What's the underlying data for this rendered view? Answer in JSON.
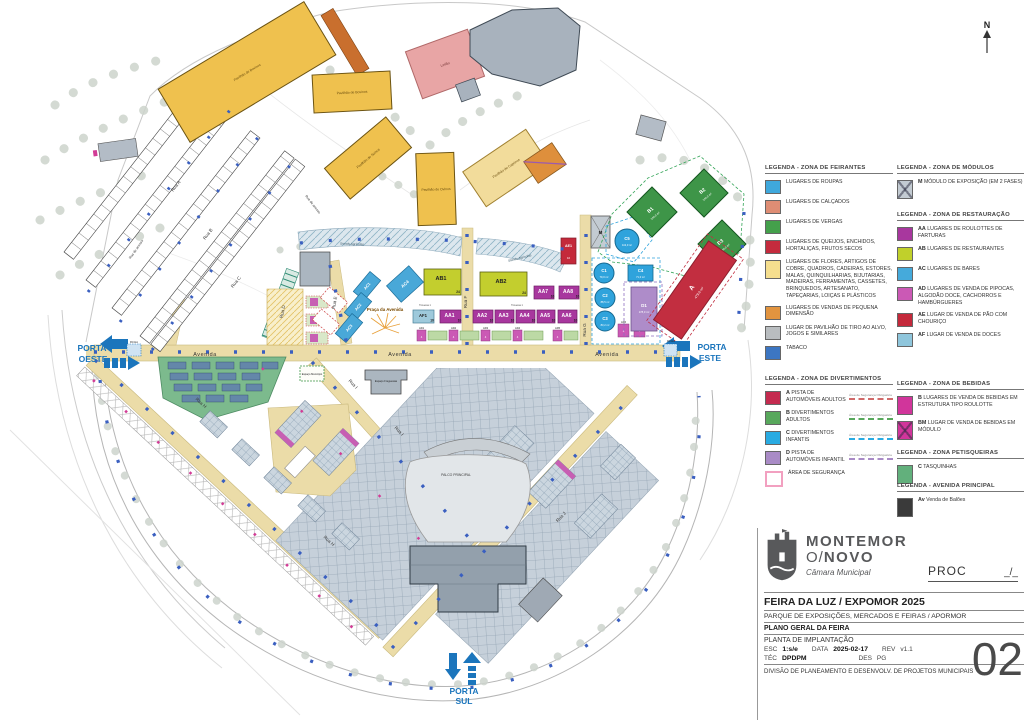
{
  "doc": {
    "proc_label": "PROC",
    "proc_value": "_/_",
    "title": "FEIRA DA LUZ / EXPOMOR 2025",
    "subtitle": "PARQUE DE EXPOSIÇÕES, MERCADOS E FEIRAS / APORMOR",
    "plan_title": "PLANO GERAL DA FEIRA",
    "drawing_title": "PLANTA DE IMPLANTAÇÃO",
    "esc_label": "ESC",
    "esc_value": "1:s/e",
    "data_label": "DATA",
    "data_value": "2025-02-17",
    "rev_label": "REV",
    "rev_value": "v1.1",
    "tec_label": "TÉC",
    "tec_value": "DPDPM",
    "des_label": "DES",
    "des_value": "PG",
    "division": "DIVISÃO DE PLANEAMENTO E DESENVOLV. DE PROJETOS MUNICIPAIS",
    "sheet": "02"
  },
  "logo": {
    "line1": "MONTEMOR",
    "line2a": "O/",
    "line2b": "NOVO",
    "line3": "Câmara Municipal"
  },
  "legend": {
    "feirantes": {
      "title": "LEGENDA - ZONA DE FEIRANTES",
      "items": [
        {
          "color": "#3FA8DC",
          "label": "LUGARES DE ROUPAS"
        },
        {
          "color": "#DE8D74",
          "label": "LUGARES DE CALÇADOS"
        },
        {
          "color": "#44A04B",
          "label": "LUGARES DE VERGAS"
        },
        {
          "color": "#C42B3D",
          "label": "LUGARES DE QUEIJOS, ENCHIDOS, HORTALIÇAS, FRUTOS SECOS"
        },
        {
          "color": "#F5DE8E",
          "label": "LUGARES DE FLORES, ARTIGOS DE COBRE, QUADROS, CADEIRAS, ESTORES, MALAS, QUINQUILHARIAS, BIJUTARIAS, MADEIRAS, FERRAMENTAS, CASSETES, BRINQUEDOS, ARTESANATO, TAPEÇARIAS, LOIÇAS E PLÁSTICOS"
        },
        {
          "color": "#E2943F",
          "label": "LUGARES DE VENDAS DE PEQUENA DIMENSÃO"
        },
        {
          "color": "#B9BDC0",
          "label": "LUGAR DE PAVILHÃO DE TIRO AO ALVO, JOGOS E SIMILARES"
        },
        {
          "color": "#3C76C2",
          "label": "TABACO"
        }
      ]
    },
    "divertimentos": {
      "title": "LEGENDA - ZONA DE DIVERTIMENTOS",
      "note": "Área de Segurança Obrigatória",
      "items": [
        {
          "color": "#C42B4F",
          "code": "A",
          "label": "PISTA DE AUTOMÓVEIS ADULTOS",
          "note_color": "#D06A6A"
        },
        {
          "color": "#58A85C",
          "code": "B",
          "label": "DIVERTIMENTOS ADULTOS",
          "note_color": "#58A85C"
        },
        {
          "color": "#29ABE2",
          "code": "C",
          "label": "DIVERTIMENTOS INFANTIS",
          "note_color": "#29ABE2"
        },
        {
          "color": "#A98BC6",
          "code": "D",
          "label": "PISTA DE AUTOMÓVEIS INFANTIL",
          "note_color": "#A98BC6"
        },
        {
          "color": "#FFFFFF",
          "border": "#F2A0C0",
          "code": "",
          "label": "ÁREA DE SEGURANÇA"
        }
      ]
    },
    "modulos": {
      "title": "LEGENDA - ZONA DE MÓDULOS",
      "items": [
        {
          "color": "#C3CBD2",
          "code": "M",
          "label": "MÓDULO DE EXPOSIÇÃO (EM 2 FASES)"
        }
      ]
    },
    "restauracao": {
      "title": "LEGENDA - ZONA DE RESTAURAÇÃO",
      "items": [
        {
          "color": "#A8379E",
          "code": "AA",
          "label": "LUGARES DE ROULOTTES DE FARTURAS"
        },
        {
          "color": "#C0D02B",
          "code": "AB",
          "label": "LUGARES DE RESTAURANTES"
        },
        {
          "color": "#45AADB",
          "code": "AC",
          "label": "LUGARES DE BARES"
        },
        {
          "color": "#CB59B5",
          "code": "AD",
          "label": "LUGARES DE VENDA DE PIPOCAS, ALGODÃO DOCE, CACHORROS E HAMBÚRGUERES"
        },
        {
          "color": "#C4293B",
          "code": "AE",
          "label": "LUGAR DE VENDA DE PÃO COM CHOURIÇO"
        },
        {
          "color": "#8FC6DC",
          "code": "AF",
          "label": "LUGAR DE VENDA DE DOCES"
        }
      ]
    },
    "bebidas": {
      "title": "LEGENDA - ZONA DE BEBIDAS",
      "items": [
        {
          "color": "#D1359B",
          "code": "B",
          "label": "LUGARES DE VENDA DE BEBIDAS EM ESTRUTURA TIPO ROULOTTE"
        },
        {
          "color": "#D1359B",
          "code": "BM",
          "label": "LUGAR DE VENDA DE BEBIDAS EM MÓDULO"
        }
      ]
    },
    "petisqueiras": {
      "title": "LEGENDA - ZONA PETISQUEIRAS",
      "items": [
        {
          "color": "#62B07C",
          "code": "C",
          "label": "TASQUINHAS"
        }
      ]
    },
    "avenida": {
      "title": "LEGENDA - AVENIDA PRINCIPAL",
      "items": [
        {
          "color": "#3A3A3A",
          "code": "Av",
          "label": "Venda de Balões"
        }
      ]
    }
  },
  "map": {
    "north": "N",
    "gates": {
      "west1": "PORTA",
      "west2": "OESTE",
      "east1": "PORTA",
      "east2": "ESTE",
      "south1": "PORTA",
      "south2": "SUL",
      "portico": "Pórtico"
    },
    "roads": {
      "avenida": "Avenida",
      "rua_a": "Rua A",
      "rua_b": "Rua B",
      "rua_c": "Rua C",
      "rua_d": "Rua D",
      "rua_e": "Rua E",
      "rua_f": "Rua F",
      "rua_g": "Rua G",
      "rua_h": "Rua H",
      "rua_i": "Rua I",
      "rua_j": "Rua J",
      "rua_acesso": "Rua de acesso",
      "travessa": "Travessa 1"
    },
    "places": {
      "praca": "Praça da Avenida",
      "palco": "PALCO PRINCIPAL",
      "leilao": "Leilão",
      "stands": "Stands Agrícolas",
      "freguesias": "Espaço Freguesias",
      "municipio": "Espaço Município",
      "pav_bovinos": "Pavilhão de Bovinos",
      "pav_ovinos": "Pavilhão de Ovinos",
      "pav_suinos": "Pavilhão de Suínos",
      "pav_caprinos": "Pavilhão de Caprinos"
    },
    "units": {
      "ab1": {
        "code": "AB1",
        "n": "24"
      },
      "ab2": {
        "code": "AB2",
        "n": "24"
      },
      "aa1": {
        "code": "AA1",
        "n": "10"
      },
      "aa2": {
        "code": "AA2",
        "n": "10"
      },
      "aa3": {
        "code": "AA3",
        "n": "10"
      },
      "aa4": {
        "code": "AA4",
        "n": "10"
      },
      "aa5": {
        "code": "AA5",
        "n": "10"
      },
      "aa6": {
        "code": "AA6",
        "n": "10"
      },
      "aa7": {
        "code": "AA7",
        "n": "10"
      },
      "aa8": {
        "code": "AA8",
        "n": "10"
      },
      "af1": {
        "code": "AF1",
        "n": "10"
      },
      "ac1": {
        "code": "AC1"
      },
      "ac2": {
        "code": "AC2"
      },
      "ac3": {
        "code": "AC3"
      },
      "ac4": {
        "code": "AC4"
      },
      "ad1": {
        "code": "AD1",
        "n": "4"
      },
      "ad2": {
        "code": "AD2",
        "n": "4"
      },
      "ad3": {
        "code": "AD3",
        "n": "4"
      },
      "ad4": {
        "code": "AD4",
        "n": "4"
      },
      "ad5": {
        "code": "AD5",
        "n": "4"
      },
      "ad6": {
        "code": "AD6",
        "n": "4"
      },
      "ad7": {
        "code": "AD7",
        "n": "4"
      },
      "ae1": {
        "code": "AE1",
        "n": "10"
      },
      "m": {
        "code": "M"
      }
    },
    "zones": {
      "a": {
        "code": "A",
        "area": "479,0 m²"
      },
      "b1": {
        "code": "B1",
        "area": "140,0 m²"
      },
      "b2": {
        "code": "B2",
        "area": "140,0 m²"
      },
      "b3": {
        "code": "B3",
        "area": "140,0 m²"
      },
      "c1": {
        "code": "C1",
        "area": "79,0 m²"
      },
      "c2": {
        "code": "C2",
        "area": "88,5 m²"
      },
      "c3": {
        "code": "C3",
        "area": "83,2 m²"
      },
      "c4": {
        "code": "C4",
        "area": "71,0 m²"
      },
      "c5": {
        "code": "C5",
        "area": "113,0 m²"
      },
      "d1": {
        "code": "D1",
        "area": "178,0 m²"
      }
    }
  }
}
